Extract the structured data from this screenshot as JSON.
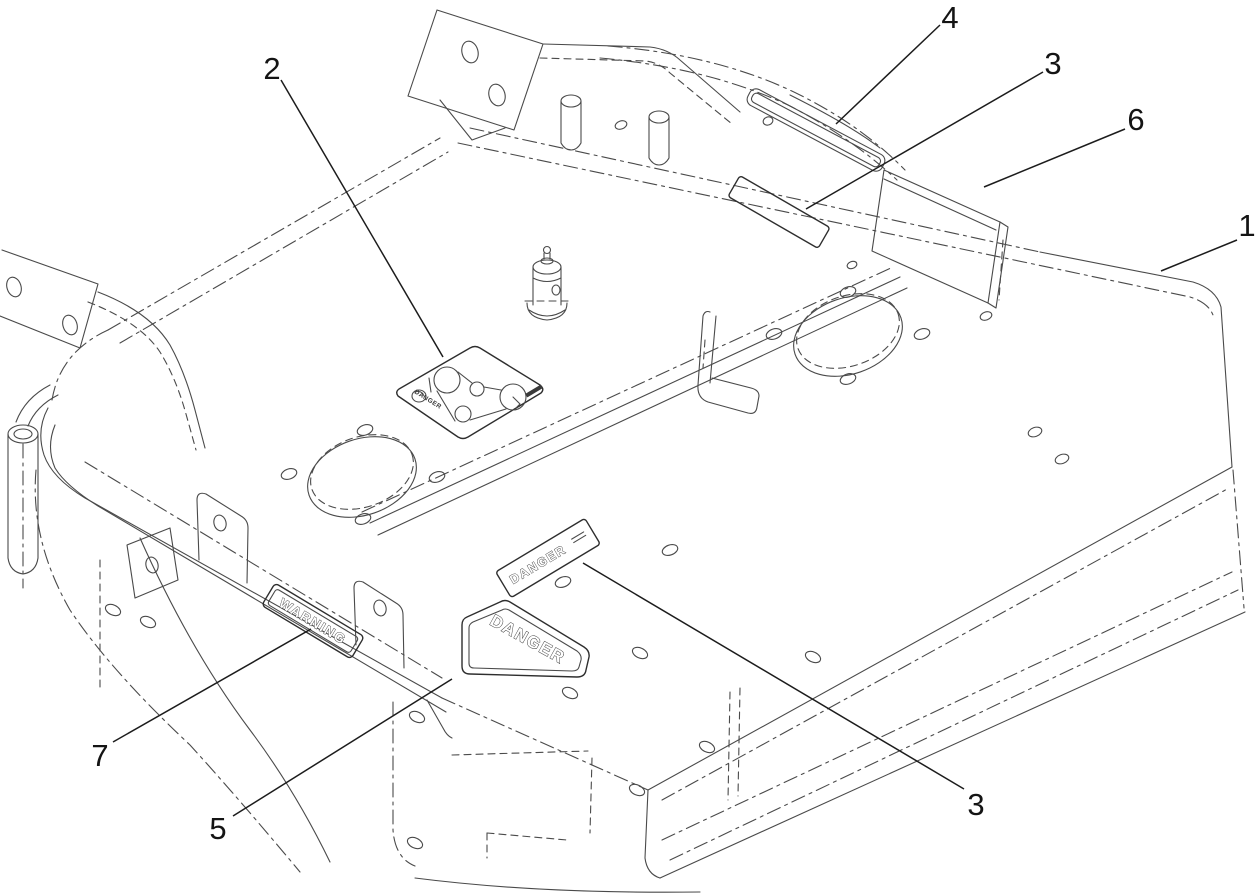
{
  "diagram": {
    "background": "#ffffff",
    "line_color": "#4a4a4a",
    "leader_color": "#1c1c1c",
    "text_color": "#141414"
  },
  "callouts": [
    {
      "label": "1"
    },
    {
      "label": "2"
    },
    {
      "label": "3"
    },
    {
      "label": "3"
    },
    {
      "label": "4"
    },
    {
      "label": "5"
    },
    {
      "label": "6"
    },
    {
      "label": "7"
    }
  ],
  "decals": {
    "danger_pentagon": "DANGER",
    "danger_strip": "DANGER",
    "warning_strip": "WARNING",
    "belt_decal_caption": "DANGER"
  }
}
